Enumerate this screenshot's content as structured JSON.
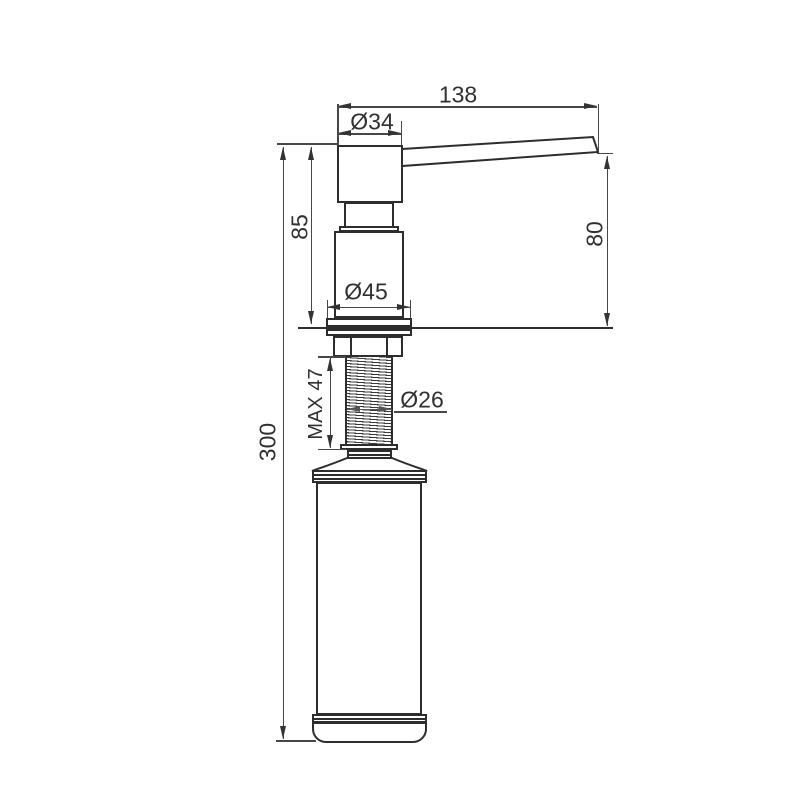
{
  "drawing": {
    "colors": {
      "outline": "#2d2d2d",
      "dimension_lines": "#474747",
      "text": "#303030",
      "background": "#ffffff"
    },
    "labels": {
      "spout_reach": "138",
      "head_diameter": "Ø34",
      "upper_height": "85",
      "outlet_height": "80",
      "flange_diameter": "Ø45",
      "overall_height": "300",
      "max_counter_thickness": "MAX 47",
      "thread_diameter": "Ø26"
    }
  }
}
